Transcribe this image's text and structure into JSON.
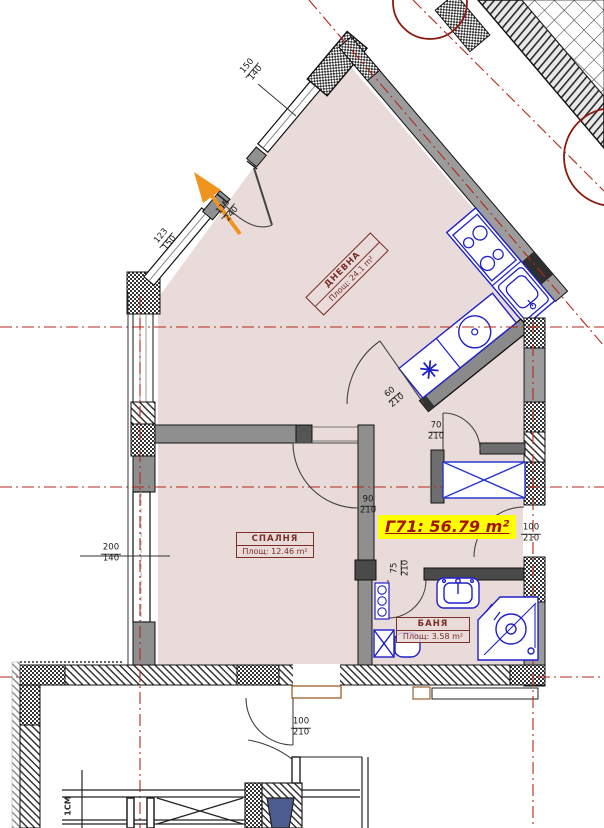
{
  "unit": {
    "label": "Г71: 56.79 m²"
  },
  "rooms": {
    "living": {
      "name": "ДНЕВНА",
      "area": "Площ: 24.1 m²"
    },
    "bedroom": {
      "name": "СПАЛНЯ",
      "area": "Площ: 12.46 m²"
    },
    "bath": {
      "name": "БАНЯ",
      "area": "Площ: 3.58 m²"
    }
  },
  "dims": {
    "win_top": {
      "w": "150",
      "h": "140"
    },
    "win_diag": {
      "w": "123",
      "h": "150"
    },
    "door_entry": {
      "w": "115",
      "h": "240"
    },
    "door_kitchen": {
      "w": "60",
      "h": "210"
    },
    "door_hall": {
      "w": "70",
      "h": "210"
    },
    "door_bedroom": {
      "w": "90",
      "h": "210"
    },
    "door_side": {
      "w": "100",
      "h": "210"
    },
    "door_bath": {
      "w": "75",
      "h": "210"
    },
    "win_left": {
      "w": "200",
      "h": "140"
    },
    "door_corridor": {
      "w": "100",
      "h": "210"
    }
  },
  "notes": {
    "stair": "1СМ"
  },
  "colors": {
    "floor": "#e8dbd9",
    "axis": "#b3281c",
    "fixture": "#2020c8",
    "accent": "#8b1a10",
    "highlight": "#ffff00",
    "arrow": "#f0941f",
    "wall_gray": "#9c9c9c"
  }
}
